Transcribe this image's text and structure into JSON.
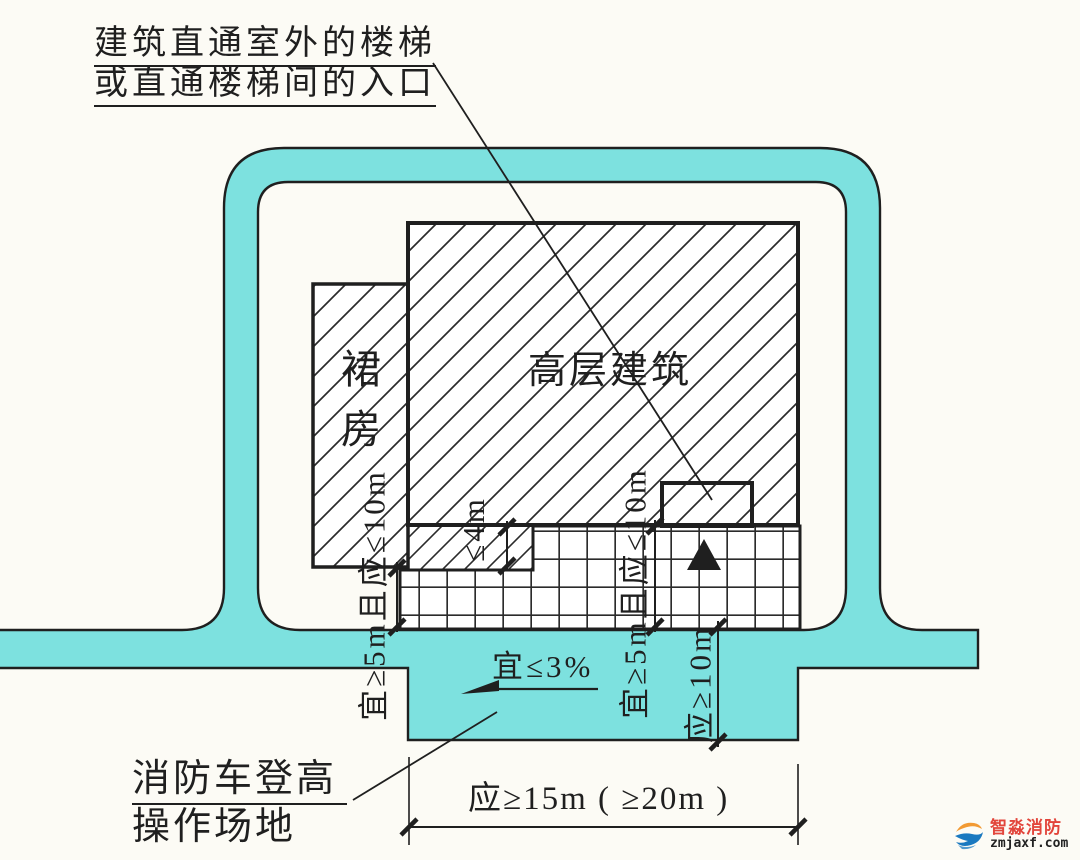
{
  "colors": {
    "road_fill": "#7de1df",
    "line": "#1f1f1f",
    "brand_red": "#e2453b",
    "brand_blue": "#1a79c0",
    "brand_orange": "#f29a33"
  },
  "annotations": {
    "stair_note_line1": "建筑直通室外的楼梯",
    "stair_note_line2": "或直通楼梯间的入口",
    "site_note_line1": "消防车登高",
    "site_note_line2": "操作场地",
    "slope_label": "宜≤3%"
  },
  "buildings": {
    "highrise_label": "高层建筑",
    "podium_label": "裙房"
  },
  "dimensions": {
    "left_offset": "宜≥5m且应≤10m",
    "right_offset": "宜≥5m且应≤10m",
    "site_depth": "应≥10m",
    "podium_projection": "≤4m",
    "site_length": "应≥15m ( ≥20m )"
  },
  "watermark": {
    "brand": "智淼消防",
    "site": "zmjaxf.com"
  }
}
